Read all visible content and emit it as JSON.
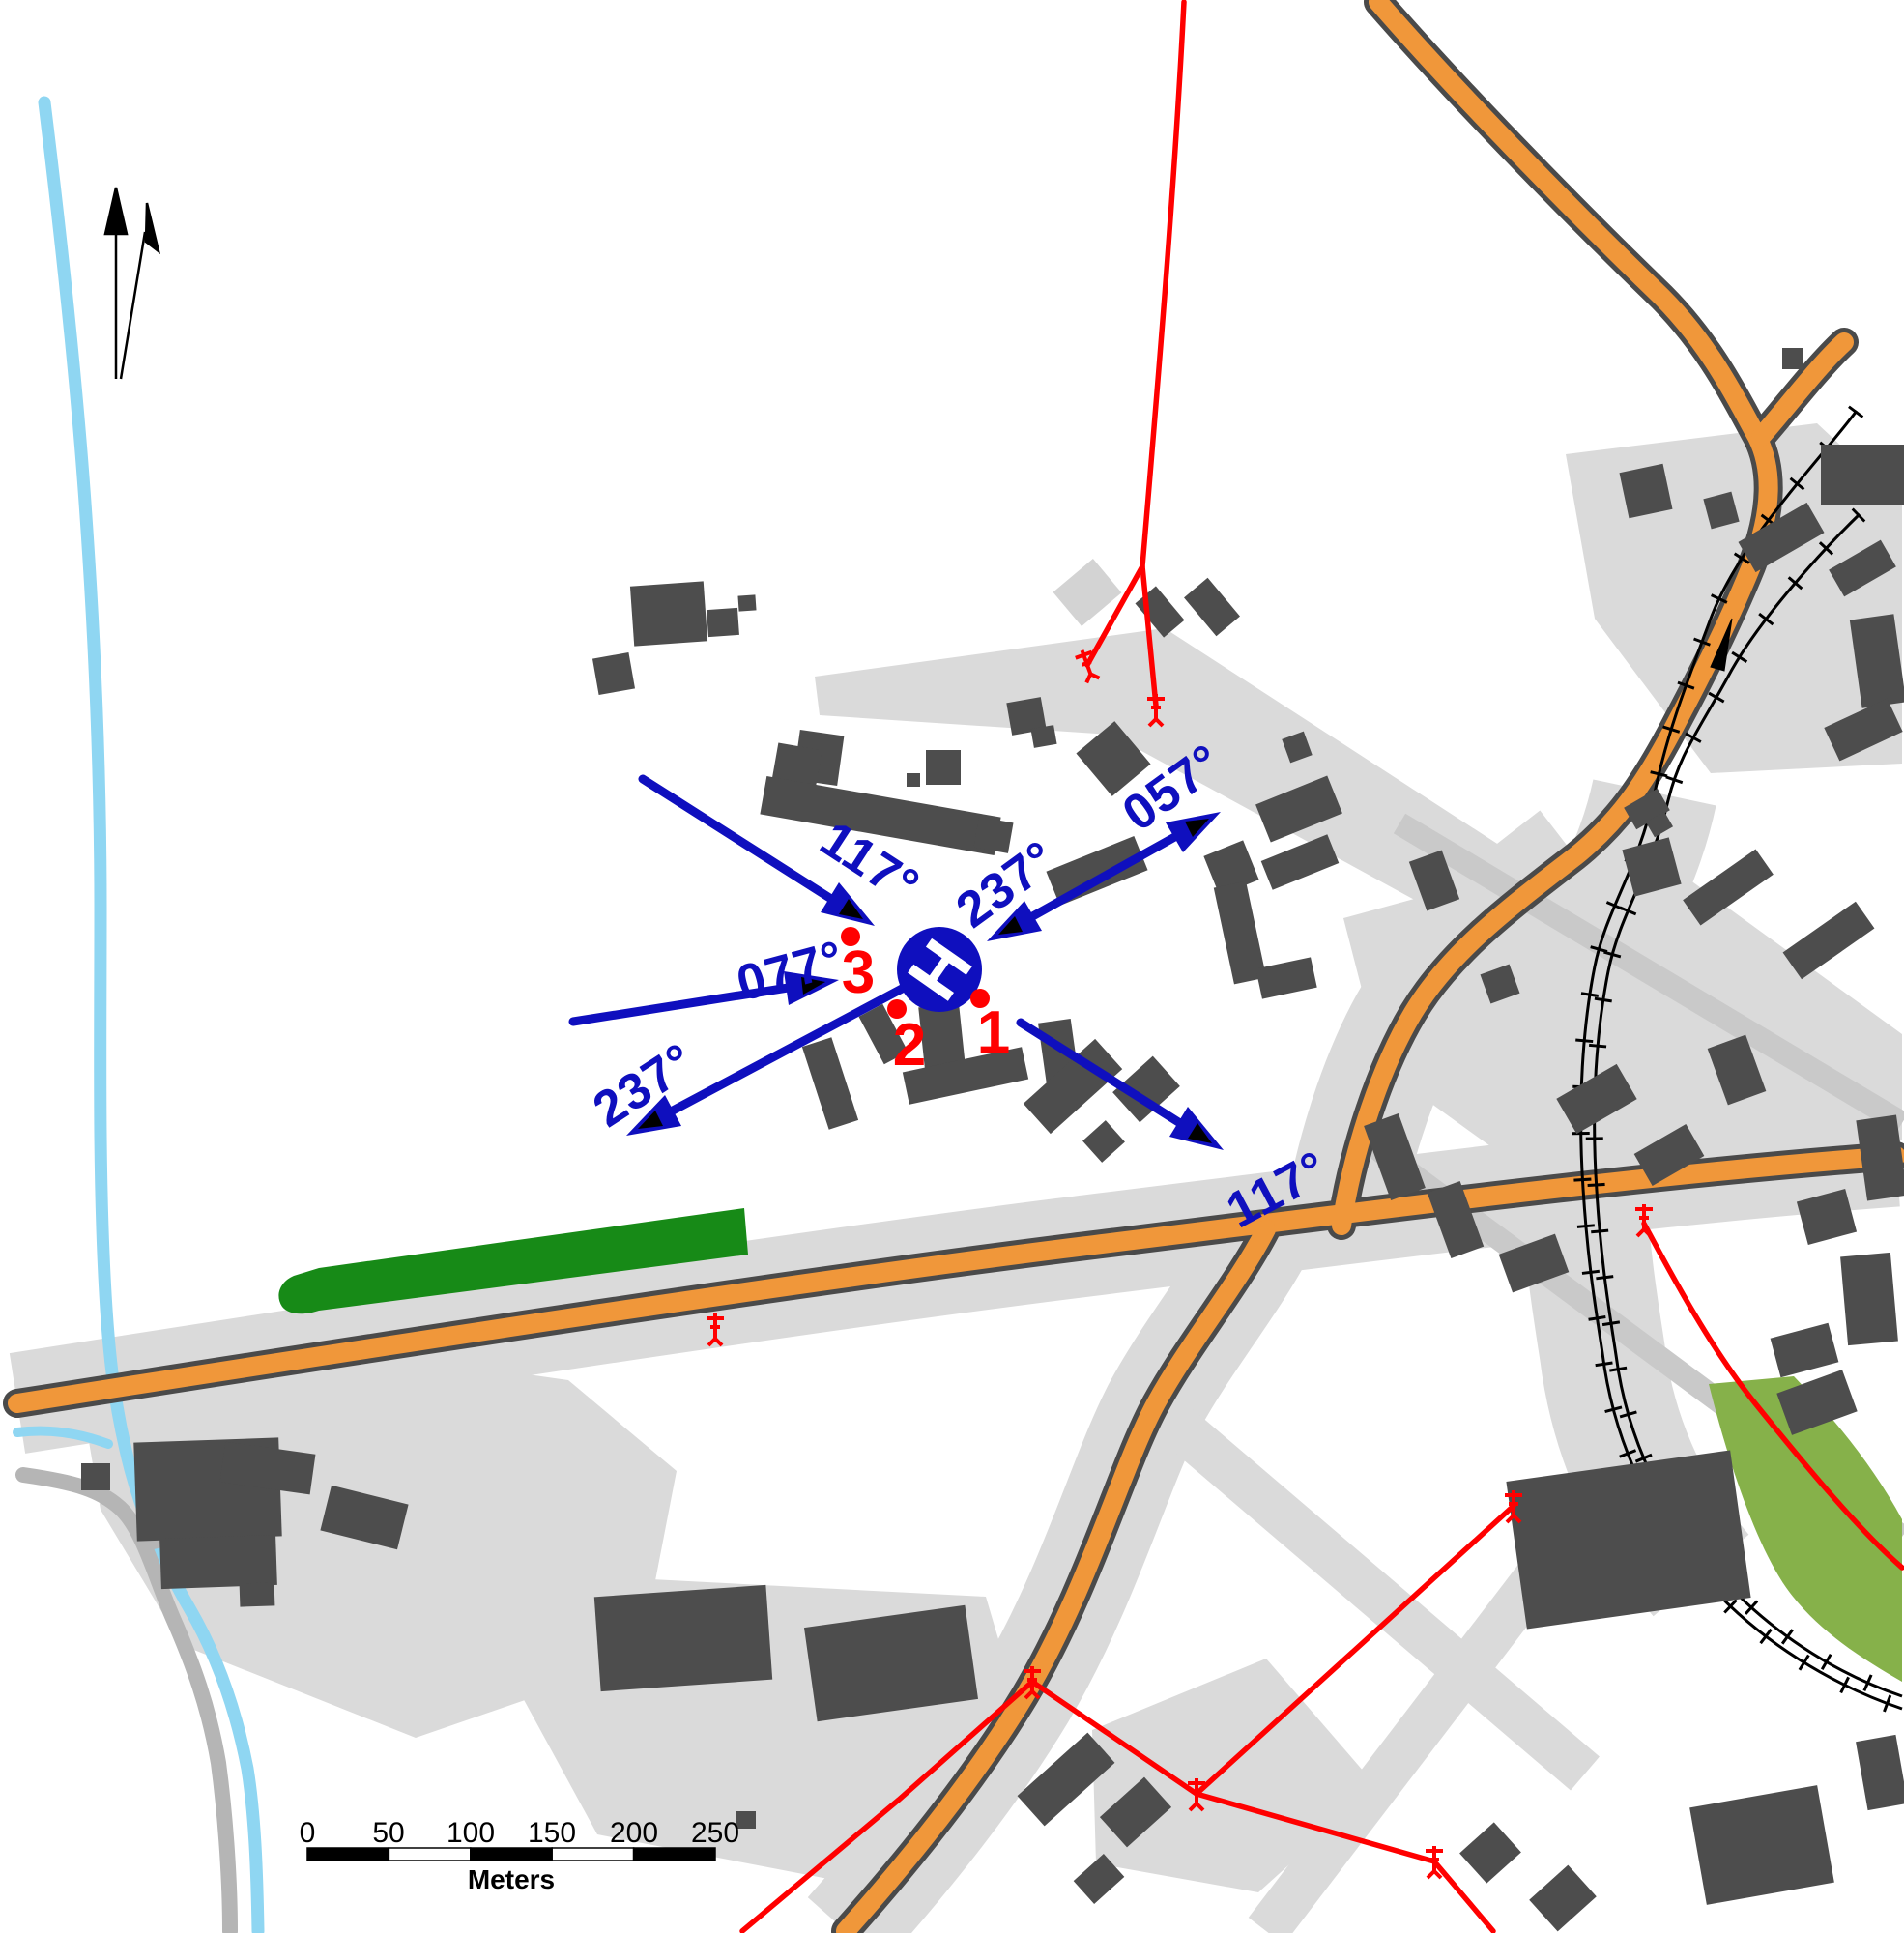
{
  "map": {
    "title": "Helicopter landing site approach chart",
    "helipad": {
      "symbol": "H"
    },
    "bearing_labels": {
      "nw_approach": "117°",
      "w_approach": "077°",
      "sw_departure": "237°",
      "ne_approach": "237°",
      "ne_departure": "057°",
      "se_departure": "117°"
    },
    "survey_points": {
      "p1": "1",
      "p2": "2",
      "p3": "3"
    },
    "scale_bar": {
      "ticks": [
        "0",
        "50",
        "100",
        "150",
        "200",
        "250"
      ],
      "unit_label": "Meters"
    },
    "colors": {
      "road_fill": "#F0973A",
      "road_casing": "#4a4a4a",
      "building": "#4d4d4d",
      "paved_area": "#dadada",
      "green_area": "#178a17",
      "green_area_light": "#86b14a",
      "water": "#8fd6f2",
      "power_line": "#ff0000",
      "annotation_blue": "#0f0fbe",
      "survey_point_red": "#ff0000"
    }
  }
}
